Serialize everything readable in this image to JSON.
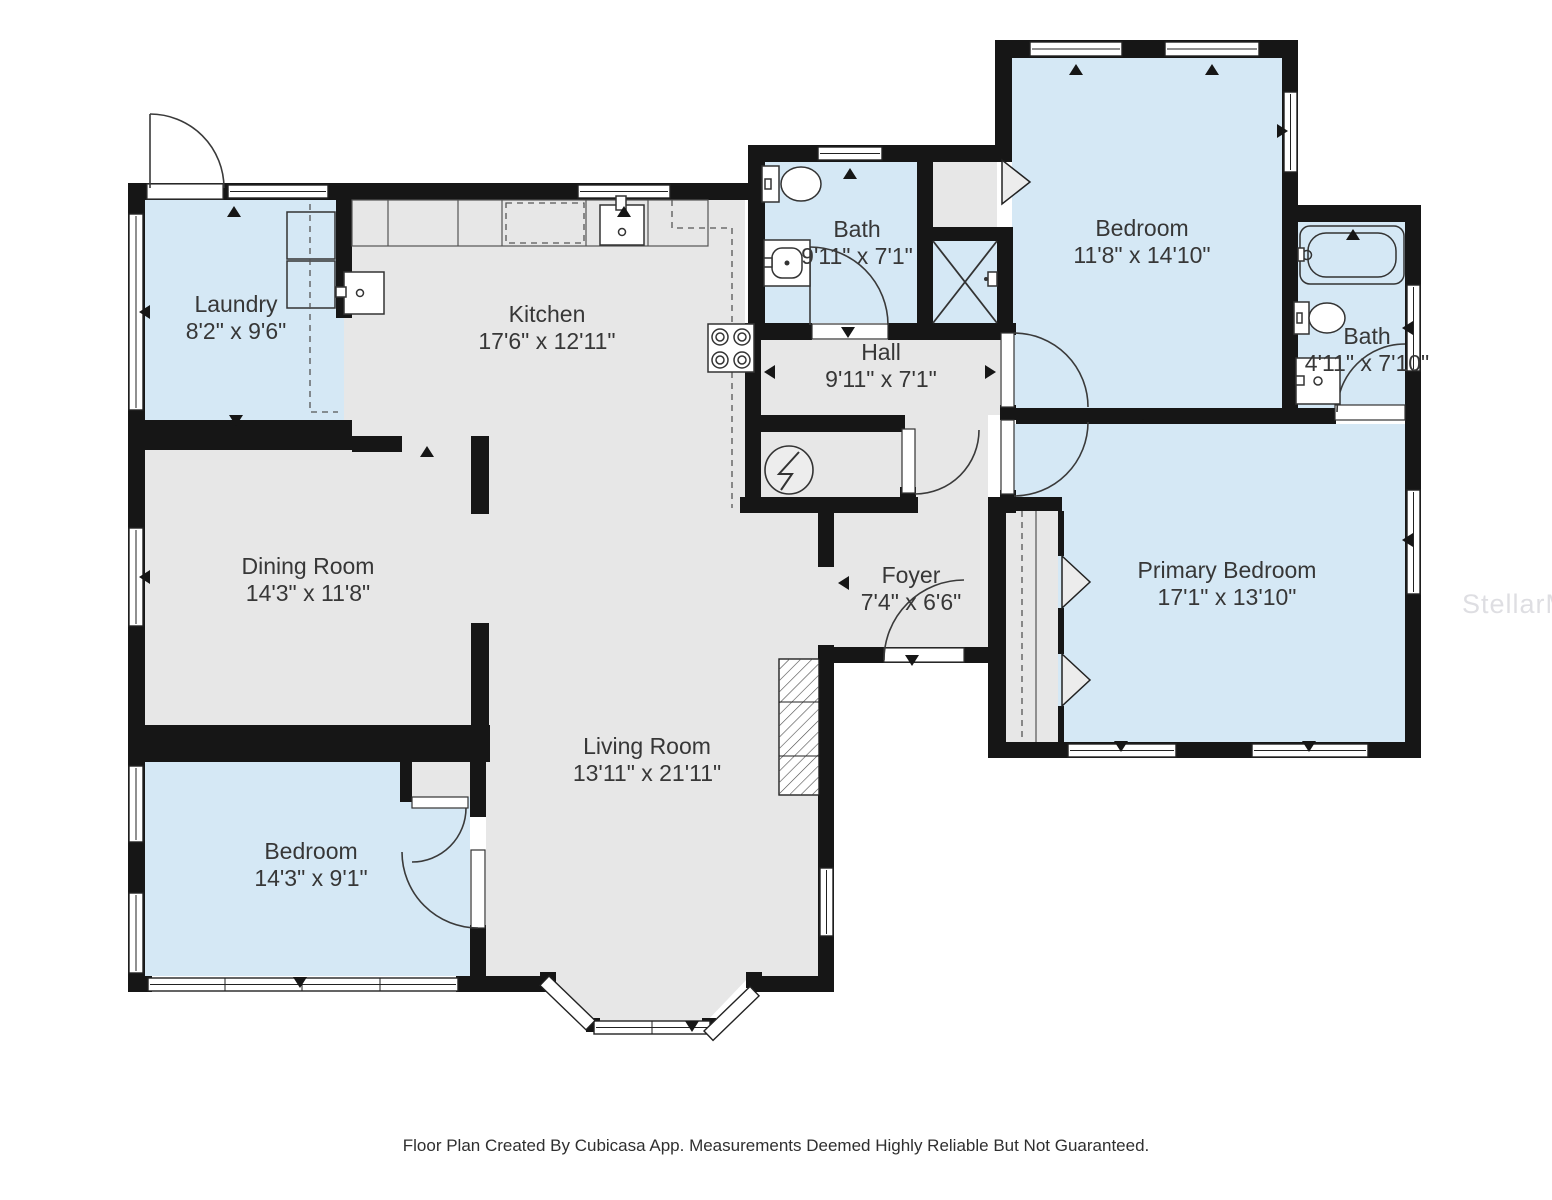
{
  "colors": {
    "room_blue": "#d5e8f5",
    "room_gray": "#e7e7e7",
    "wall_black": "#161616",
    "label_text": "#373737",
    "watermark_gray": "#d3d3d9",
    "background": "#ffffff"
  },
  "rooms": [
    {
      "id": "laundry",
      "name": "Laundry",
      "dimensions": "8'2\" x 9'6\"",
      "floor": "blue"
    },
    {
      "id": "kitchen",
      "name": "Kitchen",
      "dimensions": "17'6\" x 12'11\"",
      "floor": "gray"
    },
    {
      "id": "hall-bath",
      "name": "Bath",
      "dimensions": "9'11\" x 7'1\"",
      "floor": "blue"
    },
    {
      "id": "hall",
      "name": "Hall",
      "dimensions": "9'11\" x 7'1\"",
      "floor": "gray"
    },
    {
      "id": "bedroom-top",
      "name": "Bedroom",
      "dimensions": "11'8\" x 14'10\"",
      "floor": "blue"
    },
    {
      "id": "ensuite-bath",
      "name": "Bath",
      "dimensions": "4'11\" x 7'10\"",
      "floor": "blue"
    },
    {
      "id": "dining-room",
      "name": "Dining Room",
      "dimensions": "14'3\" x 11'8\"",
      "floor": "gray"
    },
    {
      "id": "primary-bedroom",
      "name": "Primary Bedroom",
      "dimensions": "17'1\" x 13'10\"",
      "floor": "blue"
    },
    {
      "id": "foyer",
      "name": "Foyer",
      "dimensions": "7'4\" x 6'6\"",
      "floor": "gray"
    },
    {
      "id": "living-room",
      "name": "Living Room",
      "dimensions": "13'11\" x 21'11\"",
      "floor": "gray"
    },
    {
      "id": "bedroom-bottom",
      "name": "Bedroom",
      "dimensions": "14'3\" x 9'1\"",
      "floor": "blue"
    }
  ],
  "fixtures": [
    "washer-dryer",
    "kitchen-counter",
    "dishwasher",
    "kitchen-sink",
    "prep-sink",
    "stove",
    "toilet",
    "vanity-sink",
    "shower",
    "bathtub",
    "water-heater",
    "fireplace",
    "closet-rod",
    "bay-window",
    "closet-chevron"
  ],
  "footer": {
    "text": "Floor Plan Created By Cubicasa App. Measurements Deemed Highly Reliable But Not Guaranteed."
  },
  "watermark": {
    "text": "StellarMLS"
  }
}
